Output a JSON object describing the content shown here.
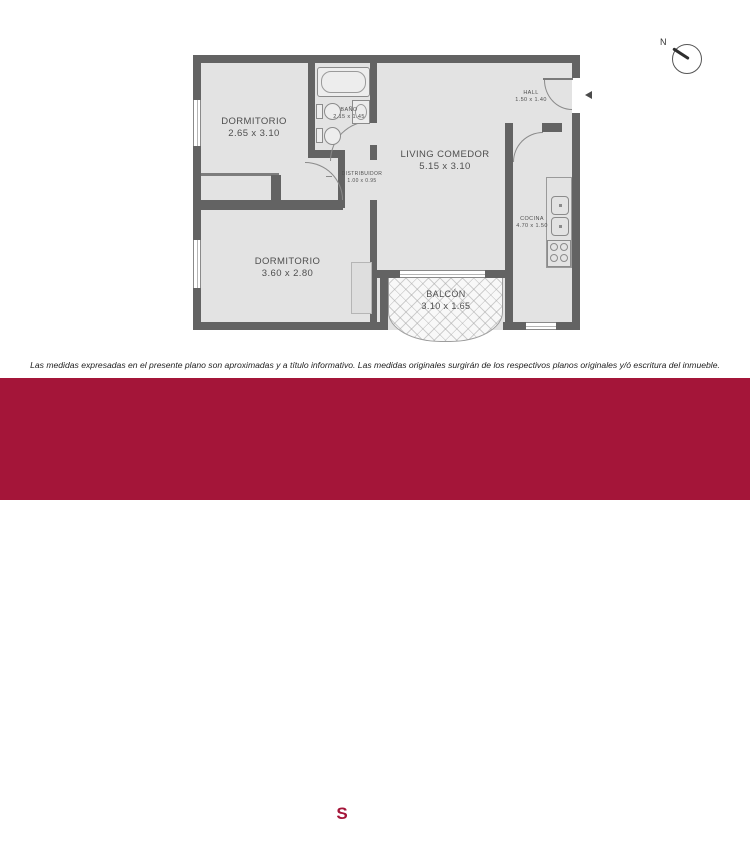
{
  "colors": {
    "band": "#A41539",
    "wall": "#636363",
    "floor": "#E3E3E3",
    "label_text": "#4F4F4F"
  },
  "plan": {
    "compass": "N",
    "rooms": [
      {
        "name": "DORMITORIO",
        "dims": "2.65 x 3.10"
      },
      {
        "name": "BAÑO",
        "dims": "2.15 x 1.45"
      },
      {
        "name": "LIVING COMEDOR",
        "dims": "5.15 x 3.10"
      },
      {
        "name": "HALL",
        "dims": "1.50 x 1.40"
      },
      {
        "name": "DISTRIBUIDOR",
        "dims": "1.00 x 0.95"
      },
      {
        "name": "DORMITORIO",
        "dims": "3.60 x 2.80"
      },
      {
        "name": "COCINA",
        "dims": "4.70 x 1.50"
      },
      {
        "name": "BALCÓN",
        "dims": "3.10 x 1.65"
      }
    ]
  },
  "disclaimer": "Las medidas expresadas en el presente plano son aproximadas y a título informativo. Las medidas originales surgirán de los respectivos planos originales y/ó escritura del inmueble.",
  "footer": {
    "doc_type": "PLANOS",
    "separator": "|",
    "address": "Dean Funes 1100, CABA",
    "brand": {
      "since": "• DESDE 1921 •",
      "name": "SPINELLI",
      "subtitle": "PROPIEDADES",
      "monogram": "S",
      "crest_glyph": "♛"
    },
    "copyright": "Spinelli Propiedades ® Copyright © Todos los derechos reservados.",
    "surface_value": "55.63M²",
    "surface_label": "Superficie Total"
  }
}
